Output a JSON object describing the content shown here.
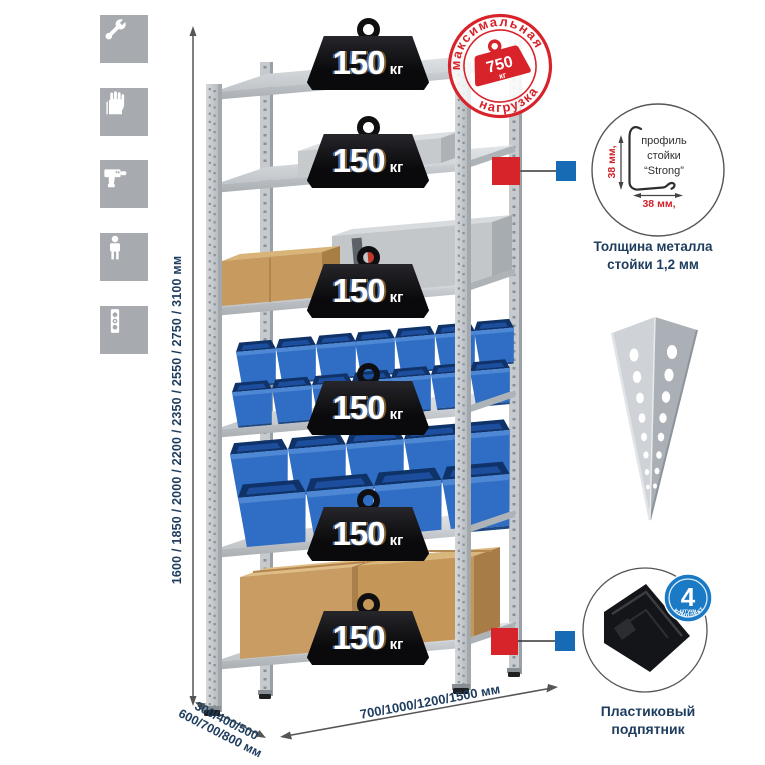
{
  "canvas": {
    "width": 765,
    "height": 765,
    "background": "#ffffff"
  },
  "sidebar": {
    "icons": [
      {
        "name": "wrench"
      },
      {
        "name": "gloves"
      },
      {
        "name": "drill"
      },
      {
        "name": "person"
      },
      {
        "name": "level"
      }
    ]
  },
  "dimensions": {
    "height_label": "1600 / 1850 / 2000 / 2200 / 2350 / 2550 / 2750 / 3100 мм",
    "depth_label_line1": "300/400/500",
    "depth_label_line2": "600/700/800 мм",
    "width_label": "700/1000/1200/1500 мм"
  },
  "stamp": {
    "arc_top": "максимальная",
    "arc_bottom": "нагрузка",
    "value": "750",
    "unit": "кг"
  },
  "rack": {
    "shelves": [
      {
        "load": "150",
        "unit": "кг"
      },
      {
        "load": "150",
        "unit": "кг"
      },
      {
        "load": "150",
        "unit": "кг"
      },
      {
        "load": "150",
        "unit": "кг"
      },
      {
        "load": "150",
        "unit": "кг"
      },
      {
        "load": "150",
        "unit": "кг"
      }
    ]
  },
  "callouts": {
    "profile": {
      "title_line1": "профиль",
      "title_line2": "стойки",
      "title_line3": "“Strong”",
      "dim_vertical": "38 мм,",
      "dim_horizontal": "38 мм,",
      "caption_line1": "Толщина металла",
      "caption_line2": "стойки 1,2 мм"
    },
    "foot": {
      "badge_value": "4",
      "badge_sub": "штуки",
      "badge_arc": "в комплекте",
      "caption_line1": "Пластиковый",
      "caption_line2": "подпятник"
    }
  },
  "colors": {
    "accent_red": "#d8232a",
    "navy_text": "#1d3c5e",
    "bin_blue": "#2f6ec4",
    "marker_blue": "#176bb5",
    "badge_blue": "#1b7ac5",
    "icon_gray": "#a7abb0",
    "metal_gray": "#c9cdd1",
    "weight_black": "#101012",
    "cardboard": "#c79a5f"
  }
}
